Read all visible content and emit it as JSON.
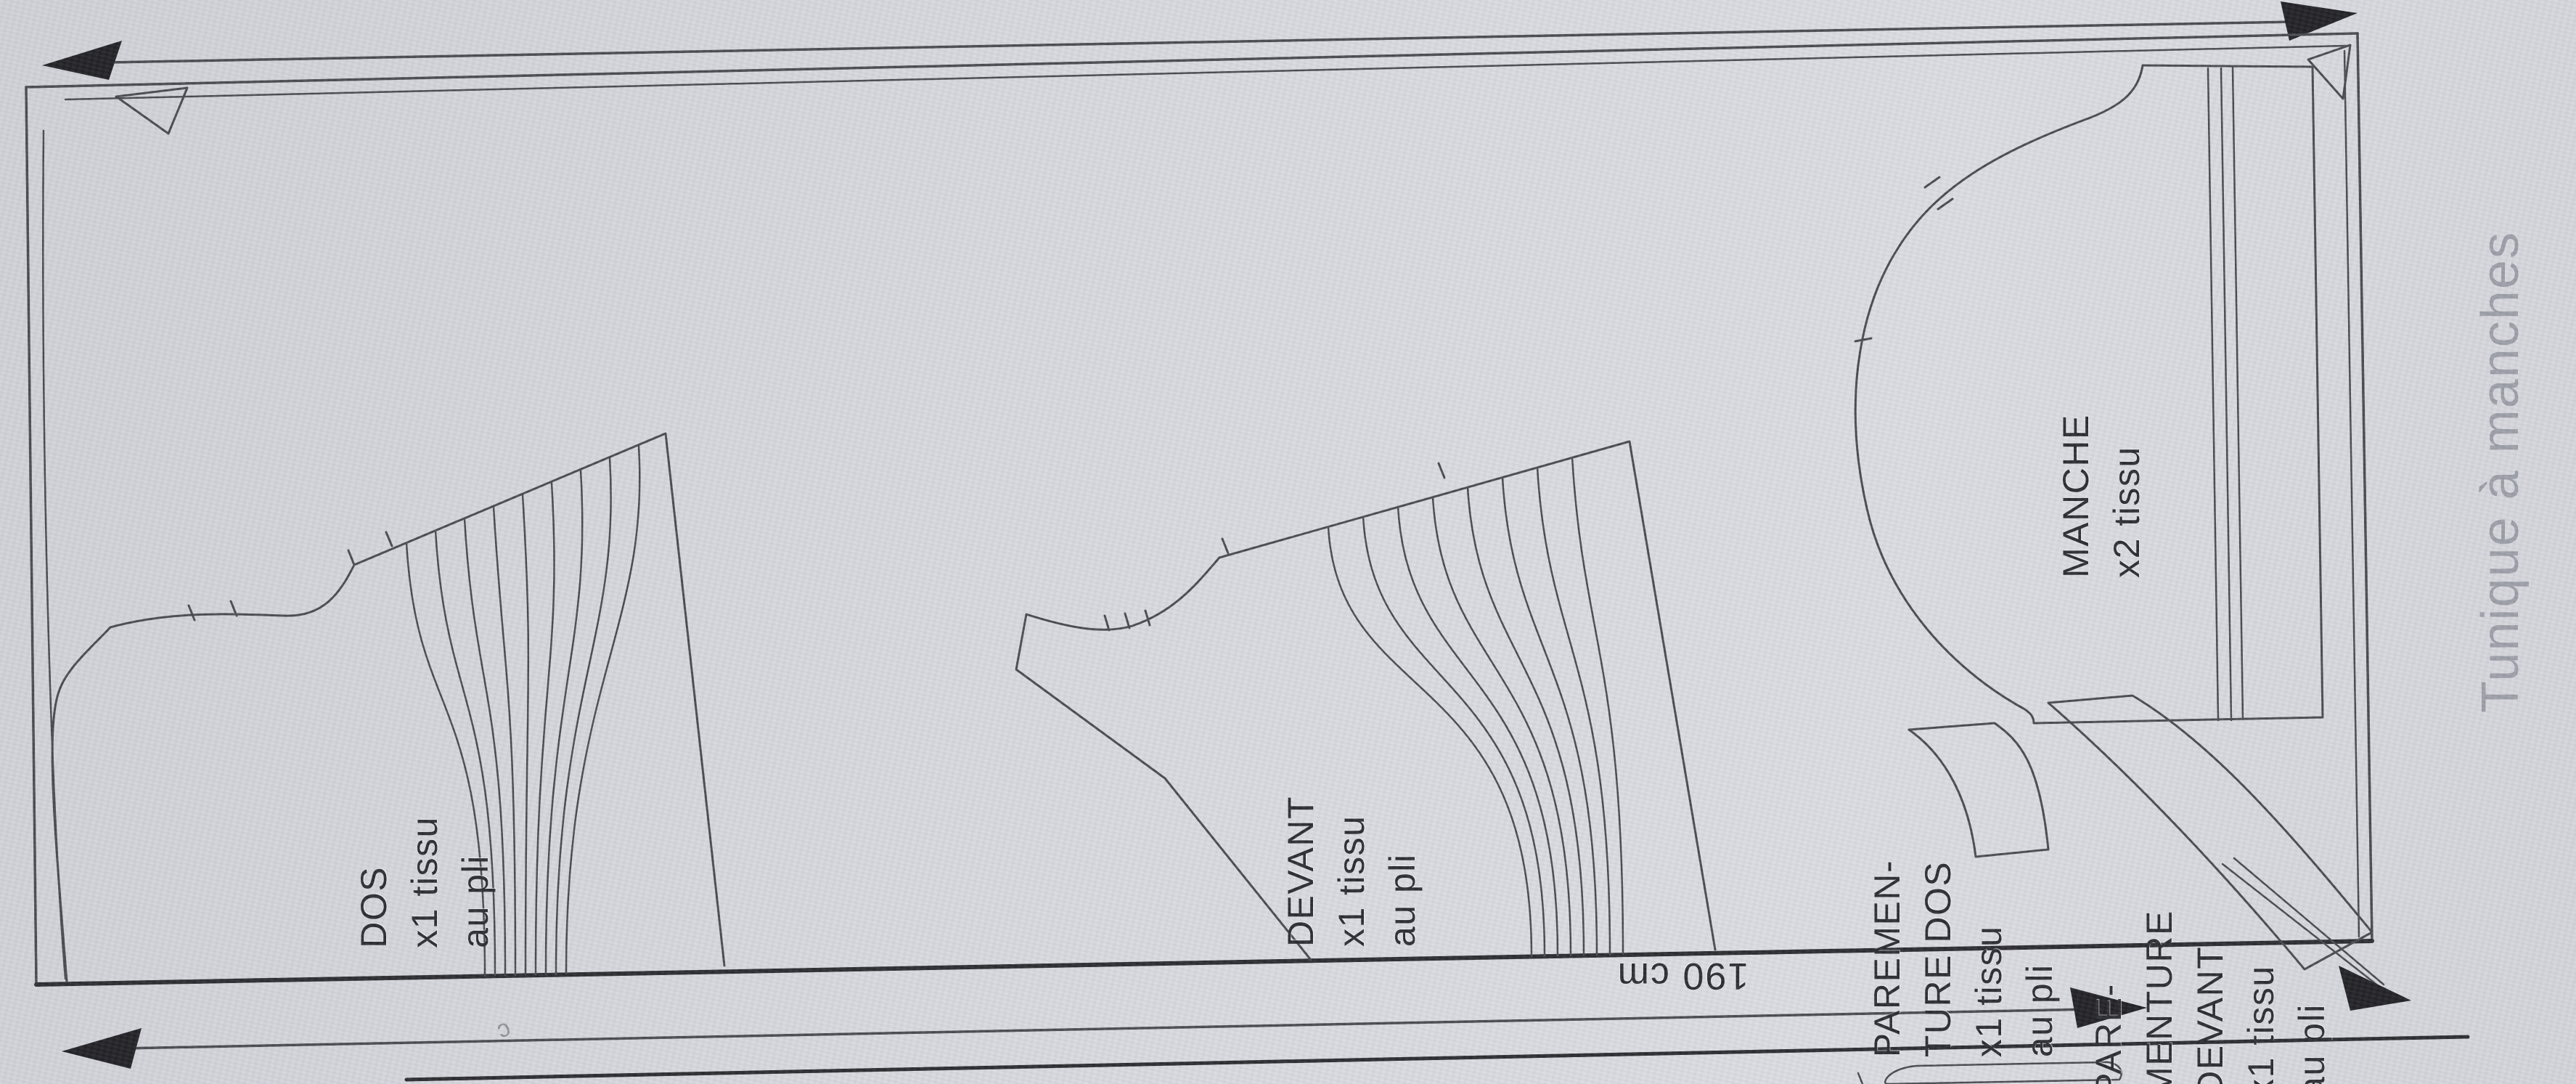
{
  "document": {
    "kind": "sewing-pattern cutting layout photo",
    "side_title": "Tunique à manches"
  },
  "fabric": {
    "width_label": "190 cm"
  },
  "pieces": {
    "dos": {
      "l1": "DOS",
      "l2": "x1 tissu",
      "l3": "au pli"
    },
    "devant": {
      "l1": "DEVANT",
      "l2": "x1 tissu",
      "l3": "au pli"
    },
    "manche": {
      "l1": "MANCHE",
      "l2": "x2 tissu"
    },
    "parementure_dos": {
      "l1": "PAREMEN-",
      "l2": "TURE DOS",
      "l3": "x1 tissu",
      "l4": "au pli"
    },
    "parementure_devant": {
      "l1": "PARE-",
      "l2": "MENTURE",
      "l3": "DEVANT",
      "l4": "x1 tissu",
      "l5": "au pli"
    }
  },
  "artifact": {
    "stray_mark": "c"
  },
  "colors": {
    "paper": "#d6d7dd",
    "outline": "#45454c",
    "heavy_edge": "#26262b",
    "arrow_fill": "#1c1c20",
    "label_text": "#26262c",
    "title_text": "#9a9ca6"
  }
}
